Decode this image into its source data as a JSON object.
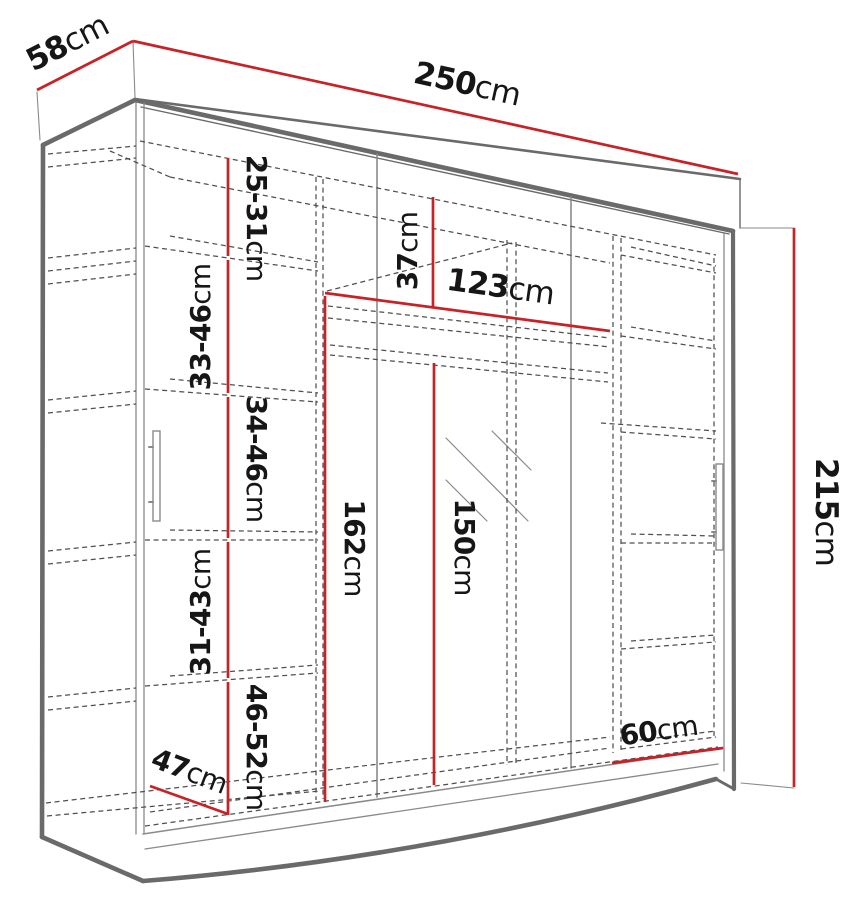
{
  "figure": "wardrobe-dimension-diagram",
  "unit": "cm",
  "dims": {
    "width": {
      "num": "250",
      "unit": "cm"
    },
    "depth": {
      "num": "58",
      "unit": "cm"
    },
    "height": {
      "num": "215",
      "unit": "cm"
    },
    "shelf_gap_top": {
      "num": "25-31",
      "unit": "cm"
    },
    "shelf_gap_2": {
      "num": "33-46",
      "unit": "cm"
    },
    "shelf_gap_3": {
      "num": "34-46",
      "unit": "cm"
    },
    "shelf_gap_4": {
      "num": "31-43",
      "unit": "cm"
    },
    "shelf_gap_bottom": {
      "num": "46-52",
      "unit": "cm"
    },
    "inner_depth": {
      "num": "47",
      "unit": "cm"
    },
    "top_gap": {
      "num": "37",
      "unit": "cm"
    },
    "mid_section_width": {
      "num": "123",
      "unit": "cm"
    },
    "left_inner_height": {
      "num": "162",
      "unit": "cm"
    },
    "rod_height": {
      "num": "150",
      "unit": "cm"
    },
    "right_section_width:": {
      "num": "60",
      "unit": "cm"
    }
  },
  "colors": {
    "dimension": "#c82227",
    "outline": "#6a6a6a",
    "text": "#161616"
  }
}
